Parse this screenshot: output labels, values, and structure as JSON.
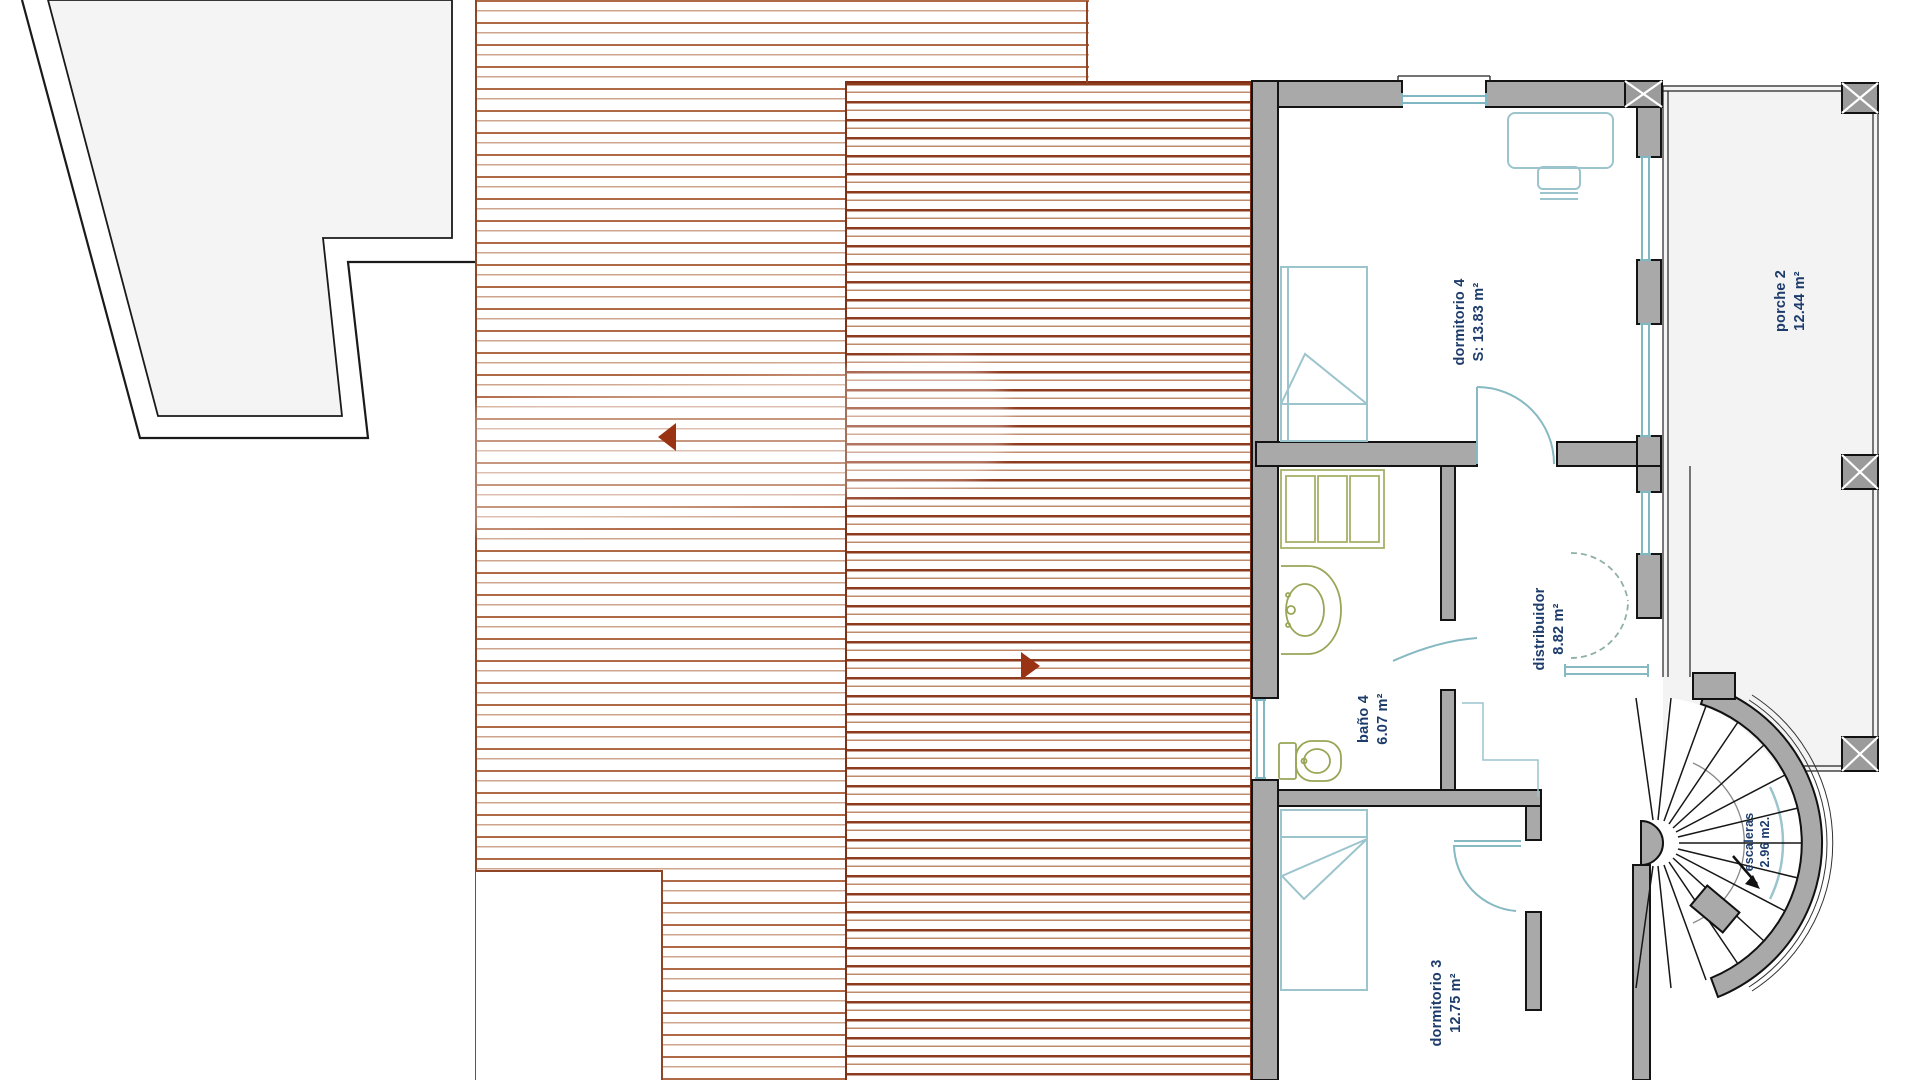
{
  "rooms": [
    {
      "id": "dormitorio-4",
      "name": "dormitorio 4",
      "area": "S: 13.83 m²"
    },
    {
      "id": "porche-2",
      "name": "porche 2",
      "area": "12.44 m²"
    },
    {
      "id": "distribuidor",
      "name": "distribuidor",
      "area": "8.82 m²"
    },
    {
      "id": "bano-4",
      "name": "baño 4",
      "area": "6.07 m²"
    },
    {
      "id": "dormitorio-3",
      "name": "dormitorio 3",
      "area": "12.75 m²"
    },
    {
      "id": "escaleras",
      "name": "escaleras",
      "area": "2.96 m2."
    }
  ],
  "icons": {
    "slope_arrow_left": "roof-slope-arrow-pointing-left",
    "slope_arrow_right": "roof-slope-arrow-pointing-right",
    "stair_direction_arrow": "stair-direction-arrow-down-right"
  },
  "colors": {
    "hatch_light": "#b06a48",
    "hatch_dark": "#8e3a1d",
    "hatch_border": "#7e3116",
    "arrow_brick": "#993314",
    "wall_gray": "#a9a9a9",
    "column_gray": "#9b9b9b",
    "window_teal": "#7fb8c2",
    "furniture_teal": "#9cc4cd",
    "fixture_olive": "#98a657",
    "label_navy": "#1d3c6b",
    "roof_fill": "#f4f4f4",
    "porch_fill": "#f3f3f3"
  }
}
